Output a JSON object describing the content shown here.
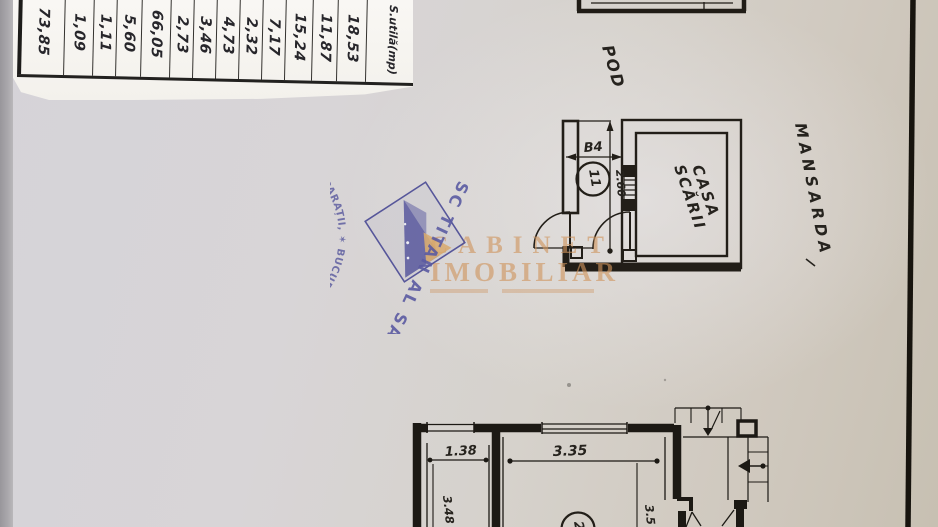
{
  "page": {
    "description": "Scanned apartment floor plan (mansarda level) with area table, company stamp and real-estate watermark"
  },
  "area_table": {
    "header": "S.utilă(mp)",
    "values_top_to_bottom": [
      "18,53",
      "11,87",
      "15,24",
      "7,17",
      "2,32",
      "4,73",
      "3,46",
      "2,73",
      "66,05",
      "5,60",
      "1,11",
      "1,09",
      "73,85"
    ],
    "display": [
      "73,85",
      "1,09",
      "1,11",
      "5,60",
      "66,05",
      "2,73",
      "3,46",
      "4,73",
      "2,32",
      "7,17",
      "15,24",
      "11,87",
      "18,53",
      "S.utilă(mp)"
    ]
  },
  "stamp": {
    "ring_text": "✶ BUCUREȘTI ✶ ADMINISTRAȚIE LOCATIVĂ, VÂNZĂRI LOCUINȚE CONSTRUCȚII, REPARAȚII, ÎNTREȚINERE",
    "company": "SC TITAN AL SA",
    "ink_color": "#5b5b9f"
  },
  "watermark": {
    "line1": "CABINET",
    "line2": "IMOBILIAR",
    "color": "#cf9a63"
  },
  "plan": {
    "labels": {
      "pod": "POD",
      "mansarda": "MANSARDA",
      "stair_room_line1": "CASA",
      "stair_room_line2": "SCĂRII"
    },
    "room_numbers": {
      "stair_hall": "11",
      "lower_room": "2"
    },
    "dims": {
      "b4": "B4",
      "hall_height": "2.60",
      "room1_width": "1.38",
      "room1_depth": "3.48",
      "room2_width": "3.35",
      "room2_depth": "3.5"
    }
  }
}
